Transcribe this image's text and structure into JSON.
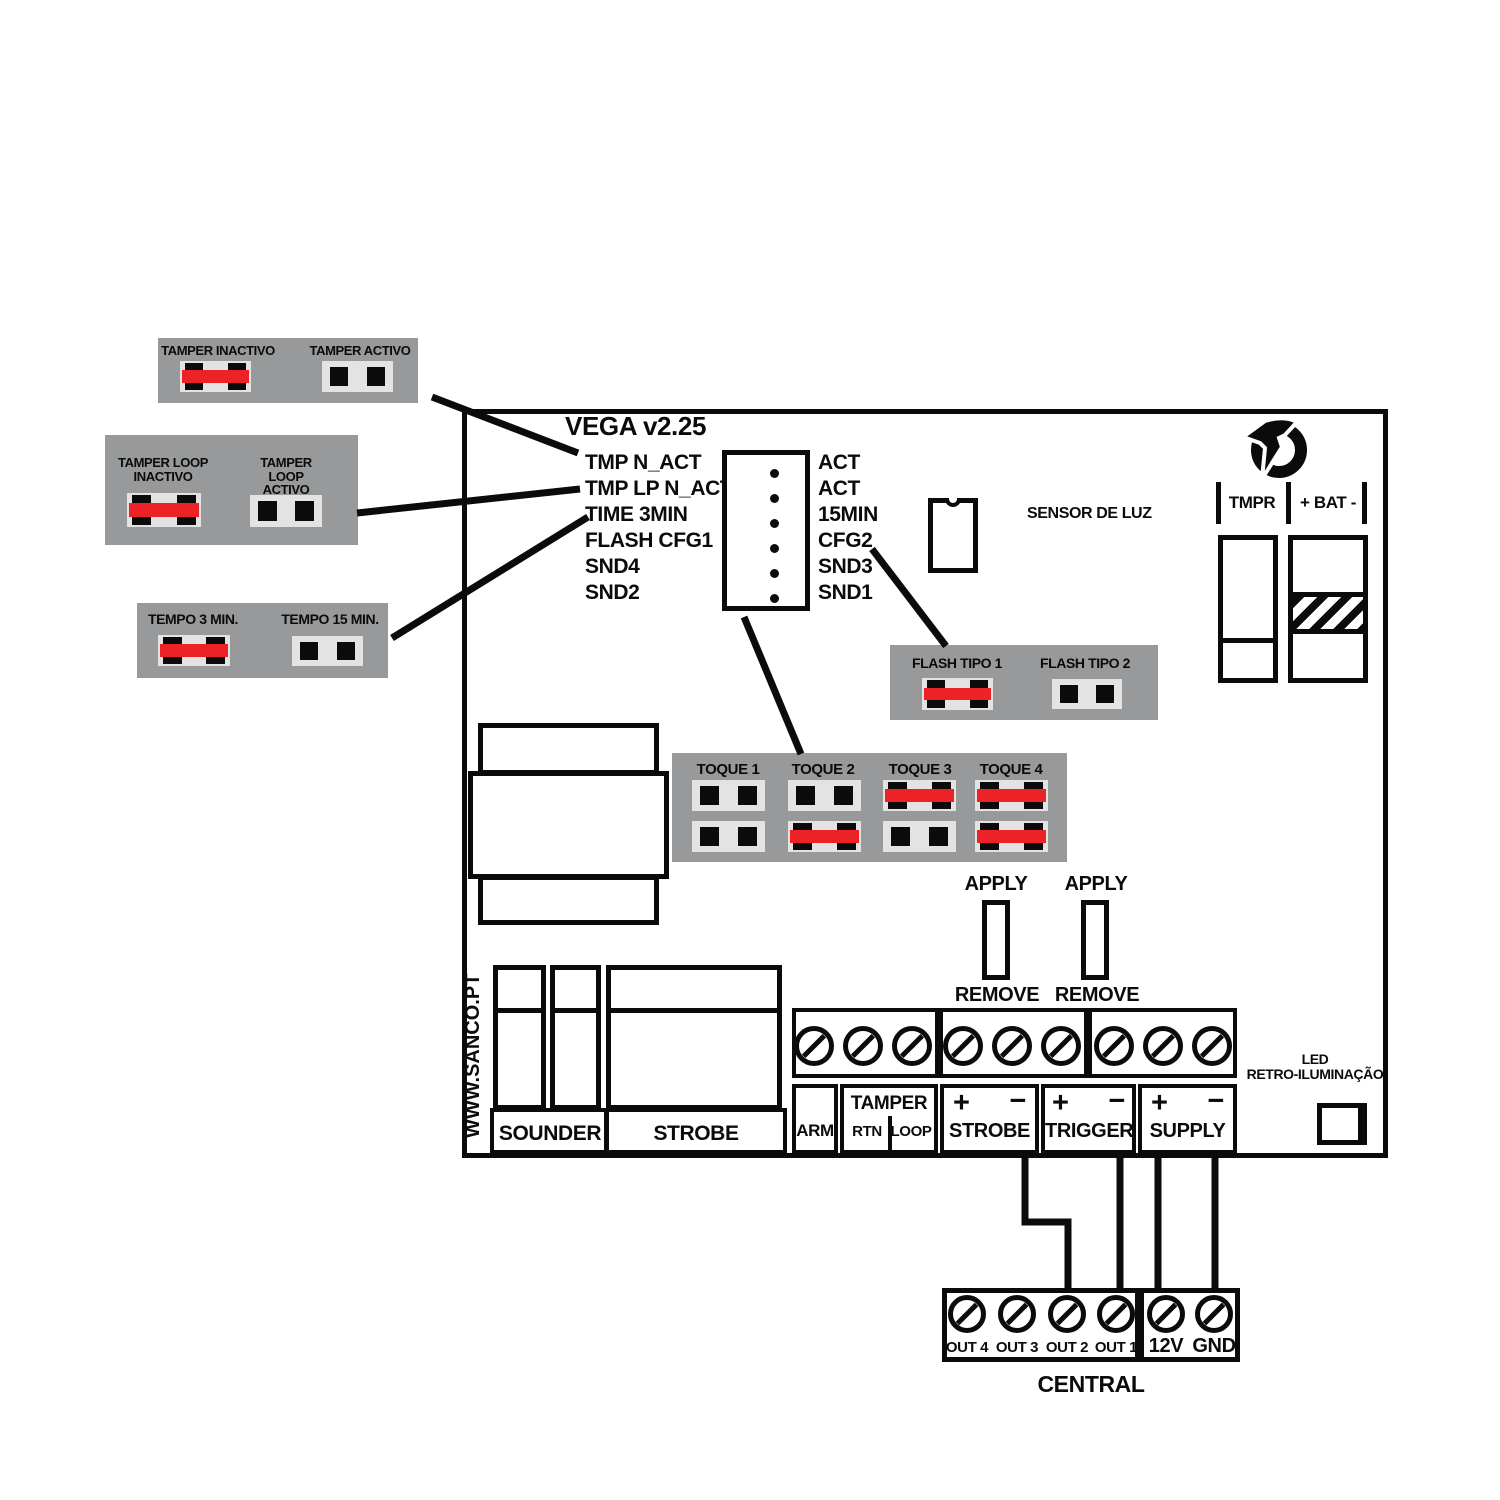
{
  "colors": {
    "panel_gray": "#97999B",
    "jumper_red": "#EC2227",
    "jumper_socket": "#E3E3E3",
    "ink": "#0B0B0B"
  },
  "board": {
    "title": "VEGA v2.25",
    "website": "WWW.SANCO.PT"
  },
  "callouts": {
    "tamper": {
      "inactive": "TAMPER INACTIVO",
      "active": "TAMPER ACTIVO"
    },
    "tamper_loop": {
      "inactive": "TAMPER LOOP\nINACTIVO",
      "active": "TAMPER LOOP\nACTIVO"
    },
    "tempo": {
      "m3": "TEMPO 3 MIN.",
      "m15": "TEMPO 15 MIN."
    },
    "flash": {
      "tipo1": "FLASH TIPO 1",
      "tipo2": "FLASH TIPO 2"
    },
    "toque": {
      "labels": [
        "TOQUE 1",
        "TOQUE 2",
        "TOQUE 3",
        "TOQUE 4"
      ]
    }
  },
  "jumper_states": {
    "tamper_inactive": "closed",
    "tamper_active": "open",
    "tamper_loop_inactive": "closed",
    "tamper_loop_active": "open",
    "tempo_3min": "closed",
    "tempo_15min": "open",
    "flash_tipo1": "closed",
    "flash_tipo2": "open",
    "toque": [
      [
        "open",
        "open"
      ],
      [
        "open",
        "closed"
      ],
      [
        "closed",
        "open"
      ],
      [
        "closed",
        "closed"
      ]
    ]
  },
  "header_block": {
    "left_labels": [
      "TMP N_ACT",
      "TMP LP N_ACT",
      "TIME 3MIN",
      "FLASH CFG1",
      "SND4",
      "SND2"
    ],
    "right_labels": [
      "ACT",
      "ACT",
      "15MIN",
      "CFG2",
      "SND3",
      "SND1"
    ]
  },
  "sensor": {
    "label": "SENSOR DE LUZ"
  },
  "battery_header": {
    "tmpr": "TMPR",
    "bat": "+ BAT -"
  },
  "strobe_trigger_jumpers": {
    "apply": "APPLY",
    "remove": "REMOVE"
  },
  "outputs": {
    "sounder": "SOUNDER",
    "strobe": "STROBE"
  },
  "terminal_strip": {
    "arm": "ARM",
    "tamper": "TAMPER",
    "rtn": "RTN",
    "loop": "LOOP",
    "strobe": "STROBE",
    "trigger": "TRIGGER",
    "supply": "SUPPLY",
    "plus": "+",
    "minus": "−"
  },
  "led": {
    "label": "LED\nRETRO-ILUMINAÇÃO"
  },
  "central": {
    "caption": "CENTRAL",
    "terminals": [
      "OUT 4",
      "OUT 3",
      "OUT 2",
      "OUT 1",
      "12V",
      "GND"
    ]
  }
}
